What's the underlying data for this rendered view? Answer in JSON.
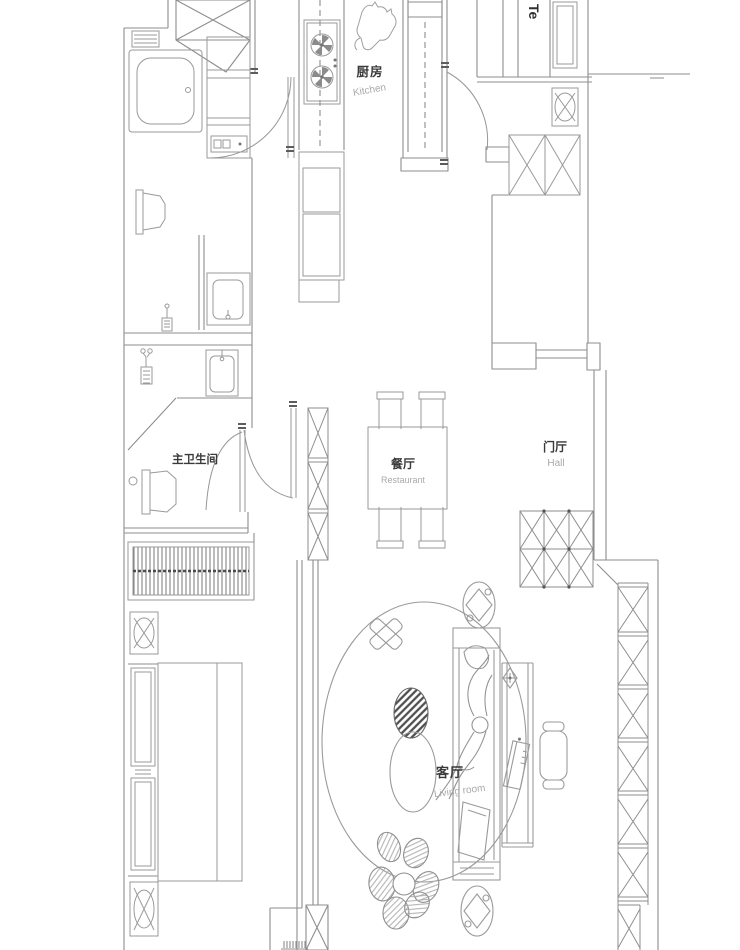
{
  "drawing": {
    "title": "apartment-floor-plan",
    "background": "#ffffff",
    "wall_color": "#8e8e8e",
    "furniture_color": "#9a9a9a",
    "dark_accent": "#555555",
    "label_color": "#3a3a3a",
    "sublabel_color": "#a9a9a9"
  },
  "labels": {
    "kitchen": {
      "zh": "厨房",
      "en": "Kitchen"
    },
    "tea_partial": {
      "en": "Te"
    },
    "master_bathroom": {
      "zh": "主卫生间"
    },
    "dining": {
      "zh": "餐厅",
      "en": "Restaurant"
    },
    "hall": {
      "zh": "门厅",
      "en": "Hall"
    },
    "living": {
      "zh": "客厅",
      "en": "Living room"
    }
  },
  "symbols": [
    "gas-stove",
    "cat",
    "bathtub",
    "storage-shelf",
    "washing-machine",
    "toilet",
    "wash-basin",
    "shower-mixer",
    "radiator",
    "flue-box",
    "double-bed",
    "window",
    "dining-table-4-chairs",
    "shoe-cabinet-grid",
    "wardrobe",
    "area-rug",
    "floor-cushion",
    "pouf",
    "sofa",
    "person-lying",
    "study-desk",
    "desk-chair",
    "book",
    "potted-plant",
    "flower-plant",
    "door-swing"
  ]
}
